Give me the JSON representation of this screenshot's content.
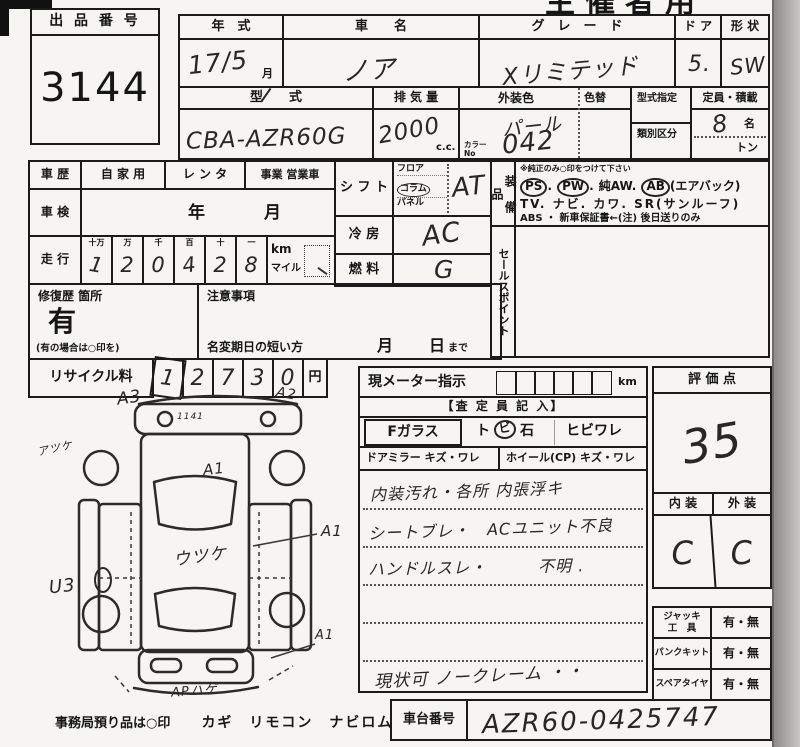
{
  "organizer": "主催者用",
  "auction": {
    "label": "出 品 番 号",
    "value": "3144"
  },
  "top": {
    "year_label": "年　式",
    "year_value": "17/5",
    "year_unit": "月",
    "name_label": "車　　名",
    "name_value": "ノア",
    "grade_label": "グ　レ　ー　ド",
    "grade_value": "Xリミテッド",
    "door_label": "ド ア",
    "door_value": "5.",
    "shape_label": "形 状",
    "shape_value": "SW",
    "model_label": "型　　式",
    "model_value": "CBA-AZR60G",
    "disp_label": "排 気 量",
    "disp_value": "2000",
    "disp_unit": "c.c.",
    "color_label": "外装色",
    "recolor_label": "色替",
    "color_value": "パール",
    "color_no_label": "カラーNo",
    "color_no_value": "042",
    "spec_label": "型式指定",
    "class_label": "類別区分",
    "cap_label": "定員・積載",
    "cap_value": "8",
    "cap_unit": "名",
    "load_unit": "トン"
  },
  "history": {
    "label": "車 歴",
    "opt1": "自 家 用",
    "opt2": "レ ン タ",
    "opt3": "事業 営業車"
  },
  "inspection": {
    "label": "車 検",
    "year": "年",
    "month": "月"
  },
  "mileage": {
    "label": "走 行",
    "h0": "十万",
    "h1": "万",
    "h2": "千",
    "h3": "百",
    "h4": "十",
    "h5": "一",
    "d0": "1",
    "d1": "2",
    "d2": "0",
    "d3": "4",
    "d4": "2",
    "d5": "8",
    "km": "km",
    "mile": "マイル"
  },
  "repair": {
    "label": "修復歴 箇所",
    "value": "有",
    "note": "(有の場合は○印を)"
  },
  "caution": {
    "label": "注意事項",
    "deadline": "名変期日の短い方",
    "month": "月",
    "day": "日",
    "until": "まで"
  },
  "recycle": {
    "label": "リサイクル料",
    "d0": "1",
    "d1": "2",
    "d2": "7",
    "d3": "3",
    "d4": "0",
    "unit": "円"
  },
  "shift": {
    "label": "シ フ ト",
    "o1": "フロア",
    "o2": "コラム",
    "o3": "パネル",
    "value": "AT"
  },
  "cool": {
    "label": "冷 房",
    "value": "AC"
  },
  "fuel": {
    "label": "燃 料",
    "value": "G"
  },
  "equip": {
    "label": "装 備 品",
    "note": "※純正のみ○印をつけて下さい",
    "ps": "PS",
    "d1": ".",
    "pw": "PW",
    "d2": ".",
    "aw": "純AW.",
    "ab": "AB",
    "ab_note": "(エアバック)",
    "line2": "TV. ナビ. カワ. SR(サンルーフ)",
    "line3": "ABS ・ 新車保証書←(注) 後日送りのみ"
  },
  "sales": {
    "label": "セールスポイント"
  },
  "meter": {
    "label": "現メーター指示",
    "unit": "km",
    "header": "【査 定 員 記 入】",
    "fglass": "Fガラス",
    "pre": "ト",
    "circ": "ビ",
    "post": "石",
    "opt2": "ヒビワレ",
    "mirror": "ドアミラー キズ・ワレ",
    "wheel": "ホイール(CP) キズ・ワレ",
    "note0": "内装汚れ・各所 内張浮キ",
    "note1": "シートブレ・　ACユニット不良",
    "note2": "ハンドルスレ・　　　不明 .",
    "note5": "現状可 ノークレーム ・・"
  },
  "score": {
    "label": "評 価 点",
    "value": "35",
    "int_label": "内 装",
    "ext_label": "外 装",
    "int_value": "C",
    "ext_value": "C"
  },
  "tools": {
    "jack1": "ジャッキ",
    "jack2": "工　具",
    "jack_v": "有・無",
    "punk": "パンクキット",
    "punk_v": "有・無",
    "spare": "スペアタイヤ",
    "spare_v": "有・無"
  },
  "chassis": {
    "label": "車台番号",
    "value": "AZR60-0425747"
  },
  "diagram": {
    "a3": "A3",
    "a2": "A2",
    "roof_note": "1141",
    "left_note": "アツケ",
    "a1_center": "A1",
    "body_note": "ウツケ",
    "a1_right": "A1",
    "u3": "U3",
    "a1_lower": "A1",
    "bottom_note": "APハゲ",
    "footer1": "事務局預り品は○印",
    "footer2": "カギ　リモコン　ナビロム"
  }
}
